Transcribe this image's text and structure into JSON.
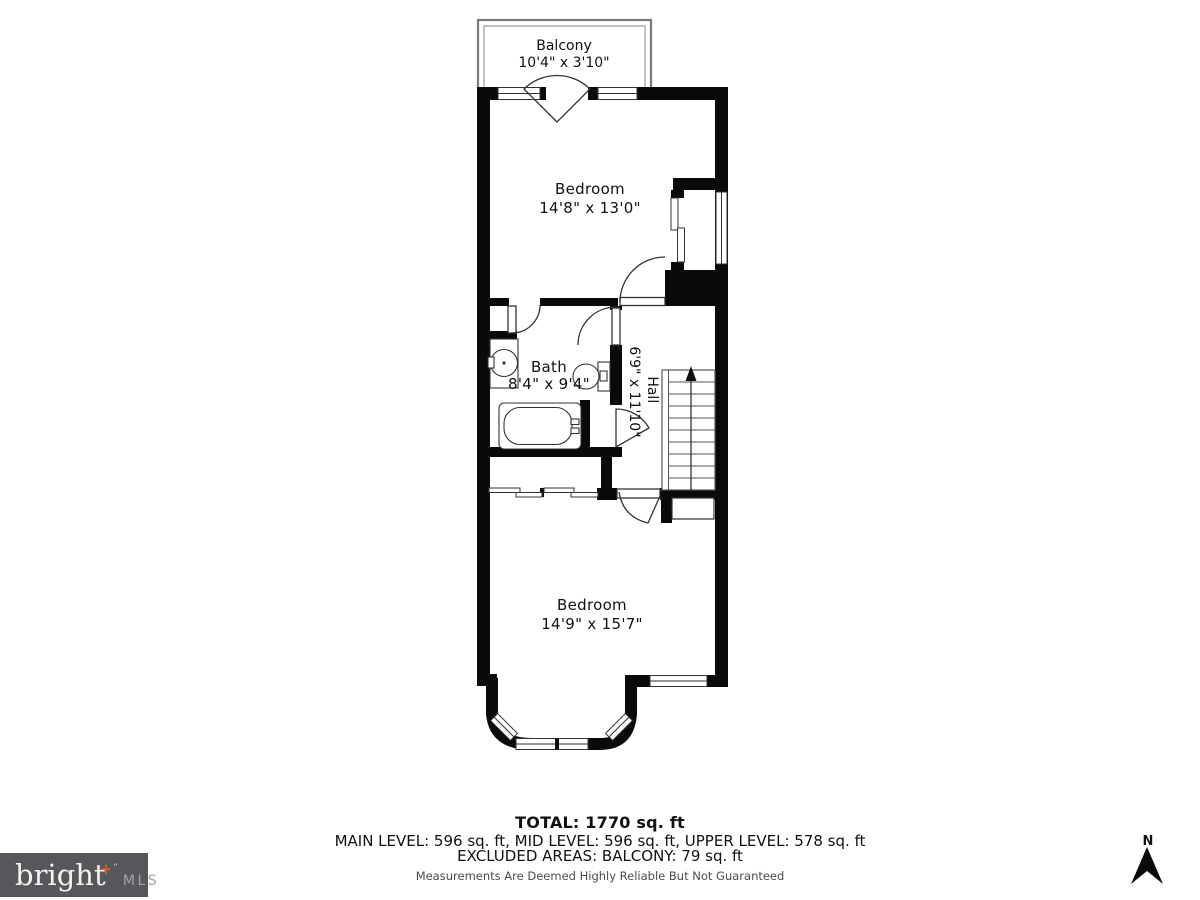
{
  "plan": {
    "balcony": {
      "label": "Balcony",
      "dims": "10'4\" x 3'10\""
    },
    "upper_bedroom": {
      "label": "Bedroom",
      "dims": "14'8\" x 13'0\""
    },
    "bath": {
      "label": "Bath",
      "dims": "8'4\" x 9'4\""
    },
    "hall": {
      "label": "Hall",
      "dims": "6'9\" x 11'10\""
    },
    "lower_bedroom": {
      "label": "Bedroom",
      "dims": "14'9\" x 15'7\""
    },
    "compass_label": "N"
  },
  "footer": {
    "total": "TOTAL: 1770 sq. ft",
    "levels": "MAIN LEVEL: 596 sq. ft, MID LEVEL: 596 sq. ft, UPPER LEVEL: 578 sq. ft",
    "excluded": "EXCLUDED AREAS: BALCONY: 79 sq. ft",
    "disclaimer": "Measurements Are Deemed Highly Reliable But Not Guaranteed"
  },
  "logo": {
    "brand": "bright",
    "plus_mark": "+",
    "tm": "”",
    "suffix": "MLS"
  },
  "colors": {
    "wall": "#0a0a0a",
    "background": "#ffffff",
    "thin_line": "#333333",
    "stairs_line": "#555555",
    "balcony_rail": "#7a7a7a",
    "logo_background": "#56575b",
    "logo_text": "#f4f3f1",
    "logo_plus": "#d95f2b",
    "logo_suffix": "#a3a5a8",
    "disclaimer_text": "#4c4c4c"
  }
}
